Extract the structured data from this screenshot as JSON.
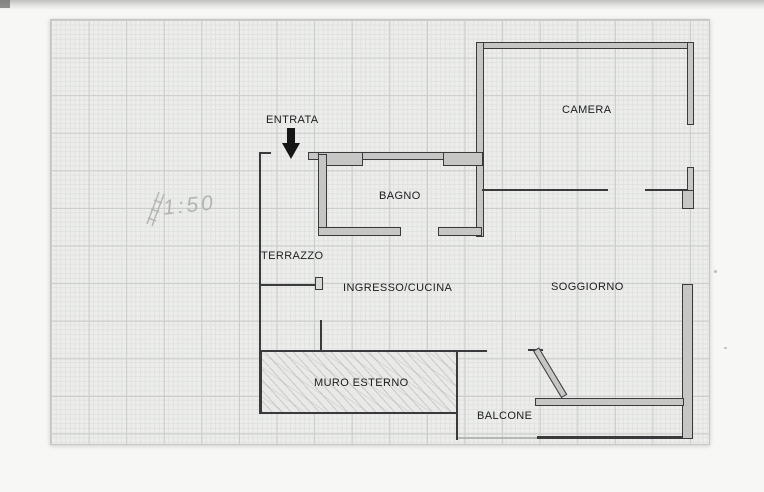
{
  "plan": {
    "type": "apartment floor plan on graph paper",
    "scale_note": "1:50",
    "entrance_label": "ENTRATA",
    "rooms": {
      "camera": "CAMERA",
      "bagno": "BAGNO",
      "terrazzo": "TERRAZZO",
      "ingresso_cucina": "INGRESSO/CUCINA",
      "soggiorno": "SOGGIORNO",
      "muro_esterno": "MURO ESTERNO",
      "balcone": "BALCONE"
    }
  },
  "colors": {
    "paper": "#edeeec",
    "grid_minor": "#e0e2e0",
    "grid_major": "#c9ccca",
    "ink": "#3a3a3c",
    "wall_fill": "#c6c7c4",
    "pencil": "#b2b4b3",
    "background": "#f7f7f5"
  }
}
